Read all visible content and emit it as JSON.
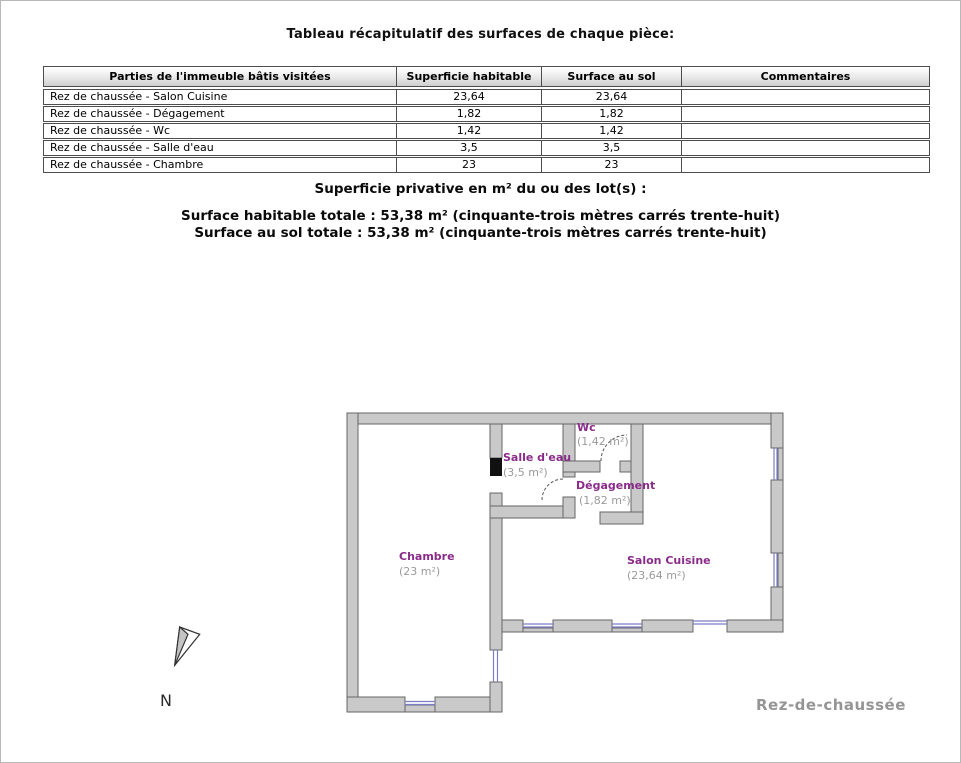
{
  "page": {
    "title": "Tableau récapitulatif des surfaces de chaque pièce:"
  },
  "table": {
    "headers": [
      "Parties de l'immeuble bâtis visitées",
      "Superficie habitable",
      "Surface au sol",
      "Commentaires"
    ],
    "rows": [
      {
        "partie": "Rez de chaussée - Salon Cuisine",
        "superficie_habitable": "23,64",
        "surface_au_sol": "23,64",
        "commentaires": ""
      },
      {
        "partie": "Rez de chaussée - Dégagement",
        "superficie_habitable": "1,82",
        "surface_au_sol": "1,82",
        "commentaires": ""
      },
      {
        "partie": "Rez de chaussée - Wc",
        "superficie_habitable": "1,42",
        "surface_au_sol": "1,42",
        "commentaires": ""
      },
      {
        "partie": "Rez de chaussée - Salle d'eau",
        "superficie_habitable": "3,5",
        "surface_au_sol": "3,5",
        "commentaires": ""
      },
      {
        "partie": "Rez de chaussée - Chambre",
        "superficie_habitable": "23",
        "surface_au_sol": "23",
        "commentaires": ""
      }
    ]
  },
  "summary": {
    "privative_heading": "Superficie privative en m² du ou des lot(s) :",
    "surface_habitable_totale": "Surface habitable totale : 53,38 m² (cinquante-trois mètres carrés trente-huit)",
    "surface_au_sol_totale": "Surface au sol totale : 53,38 m² (cinquante-trois mètres carrés trente-huit)"
  },
  "floorplan": {
    "rooms": [
      {
        "name": "Chambre",
        "area": "(23 m²)"
      },
      {
        "name": "Salle d'eau",
        "area": "(3,5 m²)"
      },
      {
        "name": "Wc",
        "area": "(1,42 m²)"
      },
      {
        "name": "Dégagement",
        "area": "(1,82 m²)"
      },
      {
        "name": "Salon Cuisine",
        "area": "(23,64 m²)"
      }
    ],
    "level_label": "Rez-de-chaussée",
    "compass_label": "N",
    "colors": {
      "wall_fill": "#c9c9c9",
      "wall_stroke": "#666666",
      "window": "#7d7dc7",
      "door_marker": "#111111",
      "room_name": "#8a2b8a",
      "room_area": "#9a9a9a",
      "level_label": "#959595"
    }
  }
}
